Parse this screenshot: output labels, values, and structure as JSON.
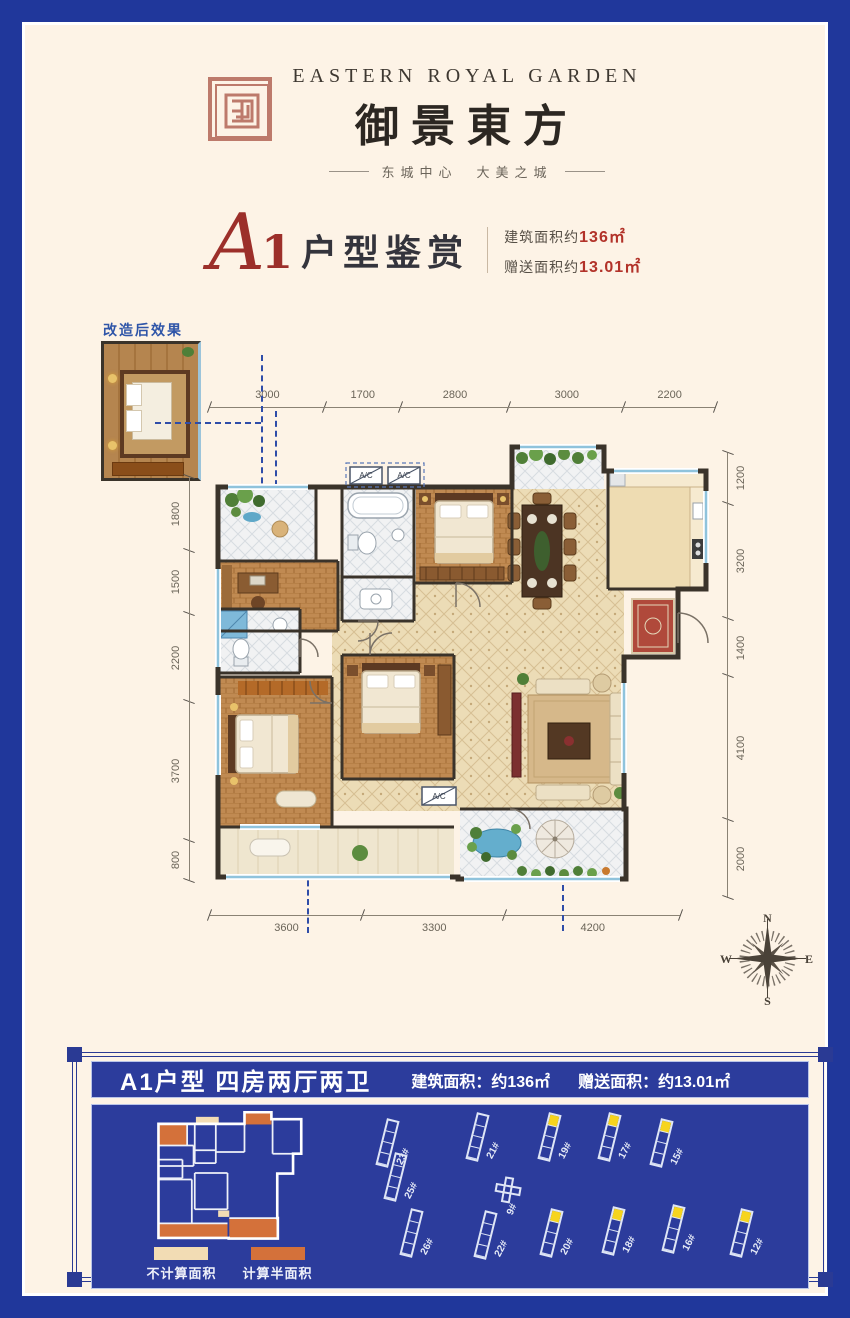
{
  "header": {
    "brand_en": "EASTERN ROYAL GARDEN",
    "brand_cn": "御景東方",
    "tagline": "东城中心　大美之城",
    "seal_color": "#bd7a6b"
  },
  "title": {
    "plan_letter": "A",
    "plan_number": "1",
    "plan_label": "户型鉴赏",
    "area_build_label": "建筑面积约",
    "area_build_value": "136㎡",
    "area_gift_label": "赠送面积约",
    "area_gift_value": "13.01㎡"
  },
  "inset": {
    "label": "改造后效果"
  },
  "floorplan": {
    "dims_top": [
      "3000",
      "1700",
      "2800",
      "3000",
      "2200"
    ],
    "dims_left": [
      "1800",
      "1500",
      "2200",
      "3700",
      "800"
    ],
    "dims_right": [
      "1200",
      "3200",
      "1400",
      "4100",
      "2000"
    ],
    "dims_bottom": [
      "3600",
      "3300",
      "4200"
    ],
    "ac_label": "A/C"
  },
  "compass": {
    "n": "N",
    "e": "E",
    "s": "S",
    "w": "W"
  },
  "panel": {
    "title": "A1户型 四房两厅两卫",
    "area_build": "建筑面积：约136㎡",
    "area_gift": "赠送面积：约13.01㎡",
    "legend": [
      {
        "label": "不计算面积",
        "color": "#f2dcb4"
      },
      {
        "label": "计算半面积",
        "color": "#d4713a"
      }
    ],
    "buildings": [
      {
        "label": "23#",
        "x": 14,
        "y": 8,
        "hl": false,
        "shape": "slab"
      },
      {
        "label": "21#",
        "x": 104,
        "y": 2,
        "hl": false,
        "shape": "slab"
      },
      {
        "label": "19#",
        "x": 176,
        "y": 2,
        "hl": true,
        "shape": "slab"
      },
      {
        "label": "17#",
        "x": 236,
        "y": 2,
        "hl": true,
        "shape": "slab"
      },
      {
        "label": "15#",
        "x": 288,
        "y": 8,
        "hl": true,
        "shape": "slab"
      },
      {
        "label": "25#",
        "x": 22,
        "y": 42,
        "hl": false,
        "shape": "slab"
      },
      {
        "label": "9#",
        "x": 128,
        "y": 66,
        "hl": false,
        "shape": "cross"
      },
      {
        "label": "26#",
        "x": 38,
        "y": 98,
        "hl": false,
        "shape": "slab"
      },
      {
        "label": "22#",
        "x": 112,
        "y": 100,
        "hl": false,
        "shape": "slab"
      },
      {
        "label": "20#",
        "x": 178,
        "y": 98,
        "hl": true,
        "shape": "slab"
      },
      {
        "label": "18#",
        "x": 240,
        "y": 96,
        "hl": true,
        "shape": "slab"
      },
      {
        "label": "16#",
        "x": 300,
        "y": 94,
        "hl": true,
        "shape": "slab"
      },
      {
        "label": "12#",
        "x": 368,
        "y": 98,
        "hl": true,
        "shape": "slab"
      }
    ]
  }
}
